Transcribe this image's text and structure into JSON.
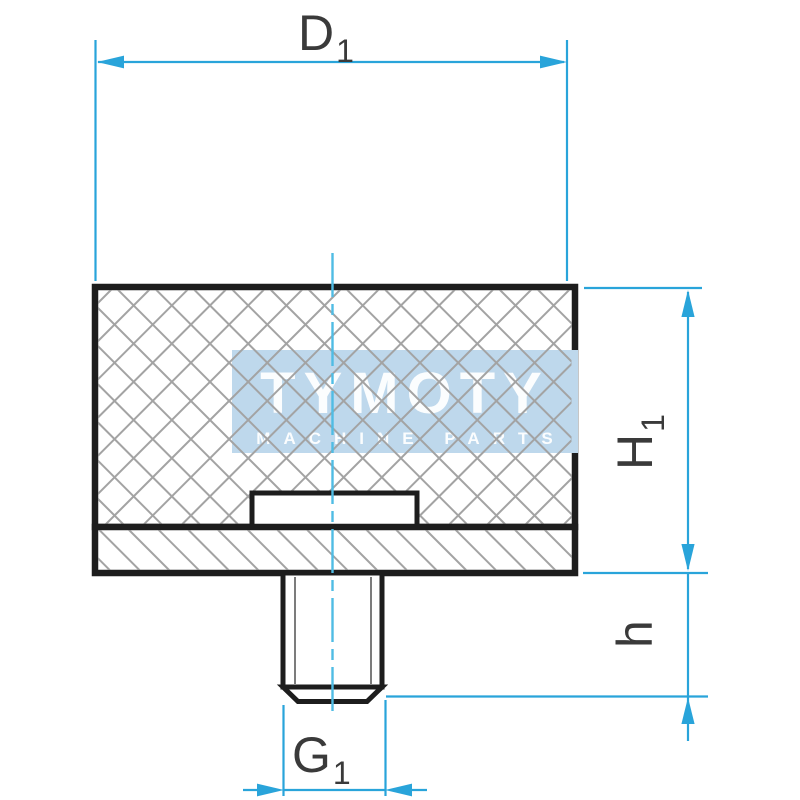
{
  "watermark": {
    "brand": "TYMOTY",
    "tagline": "MACHINE PARTS"
  },
  "dimensions": {
    "d1": {
      "base": "D",
      "sub": "1"
    },
    "h1": {
      "base": "H",
      "sub": "1"
    },
    "h": {
      "base": "h",
      "sub": ""
    },
    "g1": {
      "base": "G",
      "sub": "1"
    }
  },
  "colors": {
    "dimension": "#29a4da",
    "centerline": "#4fbce4",
    "line": "#1d1d1d",
    "hatch": "#a3a3a3",
    "label": "#3a3a3a",
    "watermark_bg": "#bed8ec",
    "watermark_text": "#ffffff"
  }
}
